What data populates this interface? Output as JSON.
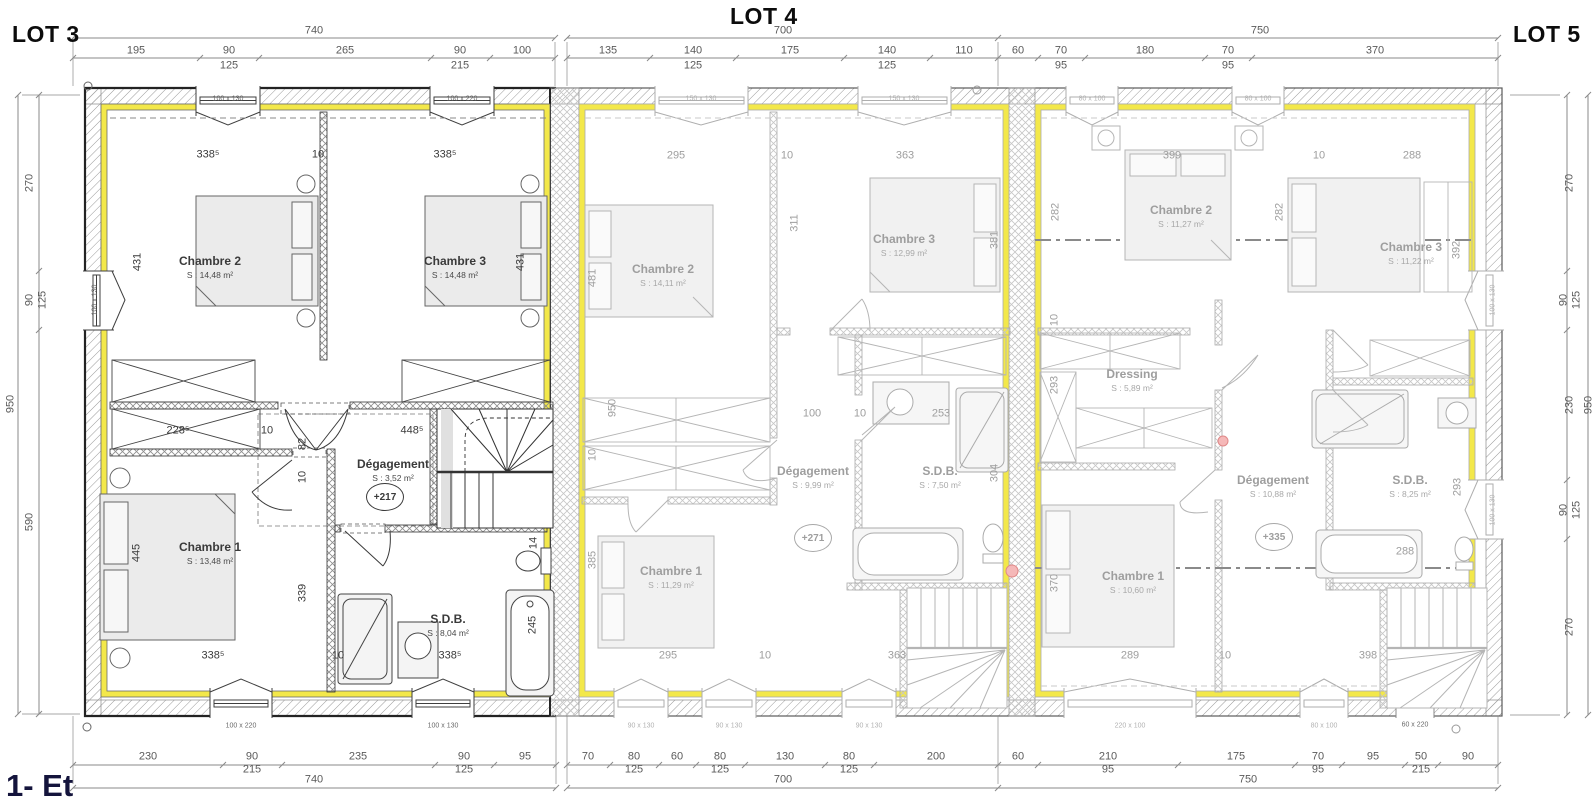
{
  "titles": {
    "lot3": "LOT 3",
    "lot4": "LOT 4",
    "lot5": "LOT 5"
  },
  "floor_label": "1- Et",
  "colors": {
    "insulation_yellow": "#f3e84a",
    "active_lot_line": "#2a2a2a",
    "faded_lot_line": "#b5b5b5",
    "dimension_text": "#5a5a5a",
    "faded_text": "#9e9e9e",
    "accent_pink": "#f0a8a8",
    "title_text": "#0c0c0c",
    "floor_label_text": "#14143c"
  },
  "annotations": {
    "outer_dims": [
      {
        "t": "740",
        "x": 314,
        "y": 31
      },
      {
        "t": "195",
        "x": 136,
        "y": 51
      },
      {
        "t": "90",
        "x": 229,
        "y": 51
      },
      {
        "t": "125",
        "x": 229,
        "y": 66
      },
      {
        "t": "265",
        "x": 345,
        "y": 51
      },
      {
        "t": "90",
        "x": 460,
        "y": 51
      },
      {
        "t": "215",
        "x": 460,
        "y": 66
      },
      {
        "t": "100",
        "x": 522,
        "y": 51
      },
      {
        "t": "700",
        "x": 783,
        "y": 31
      },
      {
        "t": "135",
        "x": 608,
        "y": 51
      },
      {
        "t": "140",
        "x": 693,
        "y": 51
      },
      {
        "t": "125",
        "x": 693,
        "y": 66
      },
      {
        "t": "175",
        "x": 790,
        "y": 51
      },
      {
        "t": "140",
        "x": 887,
        "y": 51
      },
      {
        "t": "125",
        "x": 887,
        "y": 66
      },
      {
        "t": "110",
        "x": 964,
        "y": 51
      },
      {
        "t": "750",
        "x": 1260,
        "y": 31
      },
      {
        "t": "60",
        "x": 1018,
        "y": 51
      },
      {
        "t": "70",
        "x": 1061,
        "y": 51
      },
      {
        "t": "95",
        "x": 1061,
        "y": 66
      },
      {
        "t": "180",
        "x": 1145,
        "y": 51
      },
      {
        "t": "70",
        "x": 1228,
        "y": 51
      },
      {
        "t": "95",
        "x": 1228,
        "y": 66
      },
      {
        "t": "370",
        "x": 1375,
        "y": 51
      },
      {
        "t": "230",
        "x": 148,
        "y": 757
      },
      {
        "t": "90",
        "x": 252,
        "y": 757
      },
      {
        "t": "215",
        "x": 252,
        "y": 770
      },
      {
        "t": "235",
        "x": 358,
        "y": 757
      },
      {
        "t": "90",
        "x": 464,
        "y": 757
      },
      {
        "t": "125",
        "x": 464,
        "y": 770
      },
      {
        "t": "95",
        "x": 525,
        "y": 757
      },
      {
        "t": "740",
        "x": 314,
        "y": 780
      },
      {
        "t": "70",
        "x": 588,
        "y": 757
      },
      {
        "t": "80",
        "x": 634,
        "y": 757
      },
      {
        "t": "125",
        "x": 634,
        "y": 770
      },
      {
        "t": "60",
        "x": 677,
        "y": 757
      },
      {
        "t": "80",
        "x": 720,
        "y": 757
      },
      {
        "t": "125",
        "x": 720,
        "y": 770
      },
      {
        "t": "130",
        "x": 785,
        "y": 757
      },
      {
        "t": "80",
        "x": 849,
        "y": 757
      },
      {
        "t": "125",
        "x": 849,
        "y": 770
      },
      {
        "t": "200",
        "x": 936,
        "y": 757
      },
      {
        "t": "700",
        "x": 783,
        "y": 780
      },
      {
        "t": "60",
        "x": 1018,
        "y": 757
      },
      {
        "t": "210",
        "x": 1108,
        "y": 757
      },
      {
        "t": "95",
        "x": 1108,
        "y": 770
      },
      {
        "t": "175",
        "x": 1236,
        "y": 757
      },
      {
        "t": "70",
        "x": 1318,
        "y": 757
      },
      {
        "t": "95",
        "x": 1318,
        "y": 770
      },
      {
        "t": "95",
        "x": 1373,
        "y": 757
      },
      {
        "t": "50",
        "x": 1421,
        "y": 757
      },
      {
        "t": "215",
        "x": 1421,
        "y": 770
      },
      {
        "t": "90",
        "x": 1468,
        "y": 757
      },
      {
        "t": "750",
        "x": 1248,
        "y": 780
      },
      {
        "t": "270",
        "x": 30,
        "y": 183,
        "r": 1
      },
      {
        "t": "90",
        "x": 30,
        "y": 300,
        "r": 1
      },
      {
        "t": "125",
        "x": 43,
        "y": 300,
        "r": 1
      },
      {
        "t": "590",
        "x": 30,
        "y": 522,
        "r": 1
      },
      {
        "t": "950",
        "x": 11,
        "y": 404,
        "r": 1
      },
      {
        "t": "270",
        "x": 1570,
        "y": 183,
        "r": 1
      },
      {
        "t": "90",
        "x": 1564,
        "y": 300,
        "r": 1
      },
      {
        "t": "125",
        "x": 1577,
        "y": 300,
        "r": 1
      },
      {
        "t": "230",
        "x": 1570,
        "y": 405,
        "r": 1
      },
      {
        "t": "90",
        "x": 1564,
        "y": 510,
        "r": 1
      },
      {
        "t": "125",
        "x": 1577,
        "y": 510,
        "r": 1
      },
      {
        "t": "270",
        "x": 1570,
        "y": 627,
        "r": 1
      },
      {
        "t": "950",
        "x": 1589,
        "y": 405,
        "r": 1
      }
    ],
    "lot3": {
      "dims": [
        {
          "t": "338⁵",
          "x": 208,
          "y": 155
        },
        {
          "t": "10",
          "x": 318,
          "y": 155
        },
        {
          "t": "338⁵",
          "x": 445,
          "y": 155
        },
        {
          "t": "431",
          "x": 138,
          "y": 262,
          "r": 1
        },
        {
          "t": "431",
          "x": 521,
          "y": 262,
          "r": 1
        },
        {
          "t": "228⁵",
          "x": 178,
          "y": 431
        },
        {
          "t": "10",
          "x": 267,
          "y": 431
        },
        {
          "t": "448⁵",
          "x": 412,
          "y": 431
        },
        {
          "t": "82",
          "x": 303,
          "y": 444,
          "r": 1
        },
        {
          "t": "10",
          "x": 303,
          "y": 477,
          "r": 1
        },
        {
          "t": "445",
          "x": 137,
          "y": 553,
          "r": 1
        },
        {
          "t": "339",
          "x": 303,
          "y": 593,
          "r": 1
        },
        {
          "t": "14",
          "x": 534,
          "y": 543,
          "r": 1
        },
        {
          "t": "245",
          "x": 533,
          "y": 625,
          "r": 1
        },
        {
          "t": "338⁵",
          "x": 213,
          "y": 656
        },
        {
          "t": "10",
          "x": 338,
          "y": 656
        },
        {
          "t": "338⁵",
          "x": 450,
          "y": 656
        }
      ],
      "windows": [
        {
          "t": "100 x 130",
          "x": 228,
          "y": 99
        },
        {
          "t": "100 x 220",
          "x": 462,
          "y": 99
        },
        {
          "t": "100 x 130",
          "x": 95,
          "y": 300,
          "r": 1
        },
        {
          "t": "100 x 220",
          "x": 241,
          "y": 726
        },
        {
          "t": "100 x 130",
          "x": 443,
          "y": 726
        }
      ],
      "rooms": [
        {
          "label": "Chambre 2",
          "area": "S : 14,48 m²",
          "x": 210,
          "y": 261
        },
        {
          "label": "Chambre 3",
          "area": "S : 14,48 m²",
          "x": 455,
          "y": 261
        },
        {
          "label": "Chambre 1",
          "area": "S : 13,48 m²",
          "x": 210,
          "y": 547
        },
        {
          "label": "Dégagement",
          "area": "S : 3,52 m²",
          "x": 393,
          "y": 464
        },
        {
          "label": "S.D.B.",
          "area": "S : 8,04 m²",
          "x": 448,
          "y": 619
        }
      ],
      "level": {
        "t": "+217",
        "x": 385,
        "y": 497
      }
    },
    "lot4": {
      "dims": [
        {
          "t": "295",
          "x": 676,
          "y": 156
        },
        {
          "t": "10",
          "x": 787,
          "y": 156
        },
        {
          "t": "363",
          "x": 905,
          "y": 156
        },
        {
          "t": "481",
          "x": 593,
          "y": 278,
          "r": 1
        },
        {
          "t": "311",
          "x": 795,
          "y": 223,
          "r": 1
        },
        {
          "t": "381",
          "x": 995,
          "y": 240,
          "r": 1
        },
        {
          "t": "950",
          "x": 613,
          "y": 408,
          "r": 1
        },
        {
          "t": "10",
          "x": 593,
          "y": 455,
          "r": 1
        },
        {
          "t": "100",
          "x": 812,
          "y": 414
        },
        {
          "t": "10",
          "x": 860,
          "y": 414
        },
        {
          "t": "253",
          "x": 941,
          "y": 414
        },
        {
          "t": "304",
          "x": 995,
          "y": 473,
          "r": 1
        },
        {
          "t": "385",
          "x": 593,
          "y": 560,
          "r": 1
        },
        {
          "t": "295",
          "x": 668,
          "y": 656
        },
        {
          "t": "10",
          "x": 765,
          "y": 656
        },
        {
          "t": "363",
          "x": 897,
          "y": 656
        }
      ],
      "windows": [
        {
          "t": "150 x 130",
          "x": 701,
          "y": 99
        },
        {
          "t": "150 x 130",
          "x": 904,
          "y": 99
        },
        {
          "t": "90 x 130",
          "x": 641,
          "y": 726
        },
        {
          "t": "90 x 130",
          "x": 729,
          "y": 726
        },
        {
          "t": "90 x 130",
          "x": 869,
          "y": 726
        }
      ],
      "rooms": [
        {
          "label": "Chambre 2",
          "area": "S : 14,11 m²",
          "x": 663,
          "y": 269
        },
        {
          "label": "Chambre 3",
          "area": "S : 12,99 m²",
          "x": 904,
          "y": 239
        },
        {
          "label": "Chambre 1",
          "area": "S : 11,29 m²",
          "x": 671,
          "y": 571
        },
        {
          "label": "Dégagement",
          "area": "S : 9,99 m²",
          "x": 813,
          "y": 471
        },
        {
          "label": "S.D.B.",
          "area": "S : 7,50 m²",
          "x": 940,
          "y": 471
        }
      ],
      "level": {
        "t": "+271",
        "x": 813,
        "y": 538
      }
    },
    "lot5": {
      "dims": [
        {
          "t": "399",
          "x": 1172,
          "y": 156
        },
        {
          "t": "10",
          "x": 1319,
          "y": 156
        },
        {
          "t": "288",
          "x": 1412,
          "y": 156
        },
        {
          "t": "282",
          "x": 1056,
          "y": 212,
          "r": 1
        },
        {
          "t": "282",
          "x": 1280,
          "y": 212,
          "r": 1
        },
        {
          "t": "392",
          "x": 1457,
          "y": 250,
          "r": 1
        },
        {
          "t": "10",
          "x": 1055,
          "y": 320,
          "r": 1
        },
        {
          "t": "293",
          "x": 1055,
          "y": 385,
          "r": 1
        },
        {
          "t": "370",
          "x": 1055,
          "y": 583,
          "r": 1
        },
        {
          "t": "293",
          "x": 1458,
          "y": 487,
          "r": 1
        },
        {
          "t": "288",
          "x": 1405,
          "y": 552
        },
        {
          "t": "289",
          "x": 1130,
          "y": 656
        },
        {
          "t": "10",
          "x": 1225,
          "y": 656
        },
        {
          "t": "398",
          "x": 1368,
          "y": 656
        }
      ],
      "windows": [
        {
          "t": "80 x 100",
          "x": 1092,
          "y": 99
        },
        {
          "t": "80 x 100",
          "x": 1258,
          "y": 99
        },
        {
          "t": "220 x 100",
          "x": 1130,
          "y": 726
        },
        {
          "t": "80 x 100",
          "x": 1324,
          "y": 726
        },
        {
          "t": "60 x 220",
          "x": 1415,
          "y": 725,
          "d": 1
        },
        {
          "t": "100 x 130",
          "x": 1493,
          "y": 300,
          "r": 1
        },
        {
          "t": "100 x 130",
          "x": 1493,
          "y": 510,
          "r": 1
        }
      ],
      "rooms": [
        {
          "label": "Chambre 2",
          "area": "S : 11,27 m²",
          "x": 1181,
          "y": 210
        },
        {
          "label": "Chambre 3",
          "area": "S : 11,22 m²",
          "x": 1411,
          "y": 247
        },
        {
          "label": "Chambre 1",
          "area": "S : 10,60 m²",
          "x": 1133,
          "y": 576
        },
        {
          "label": "Dressing",
          "area": "S : 5,89 m²",
          "x": 1132,
          "y": 374
        },
        {
          "label": "Dégagement",
          "area": "S : 10,88 m²",
          "x": 1273,
          "y": 480
        },
        {
          "label": "S.D.B.",
          "area": "S : 8,25 m²",
          "x": 1410,
          "y": 480
        }
      ],
      "level": {
        "t": "+335",
        "x": 1274,
        "y": 537
      }
    }
  }
}
